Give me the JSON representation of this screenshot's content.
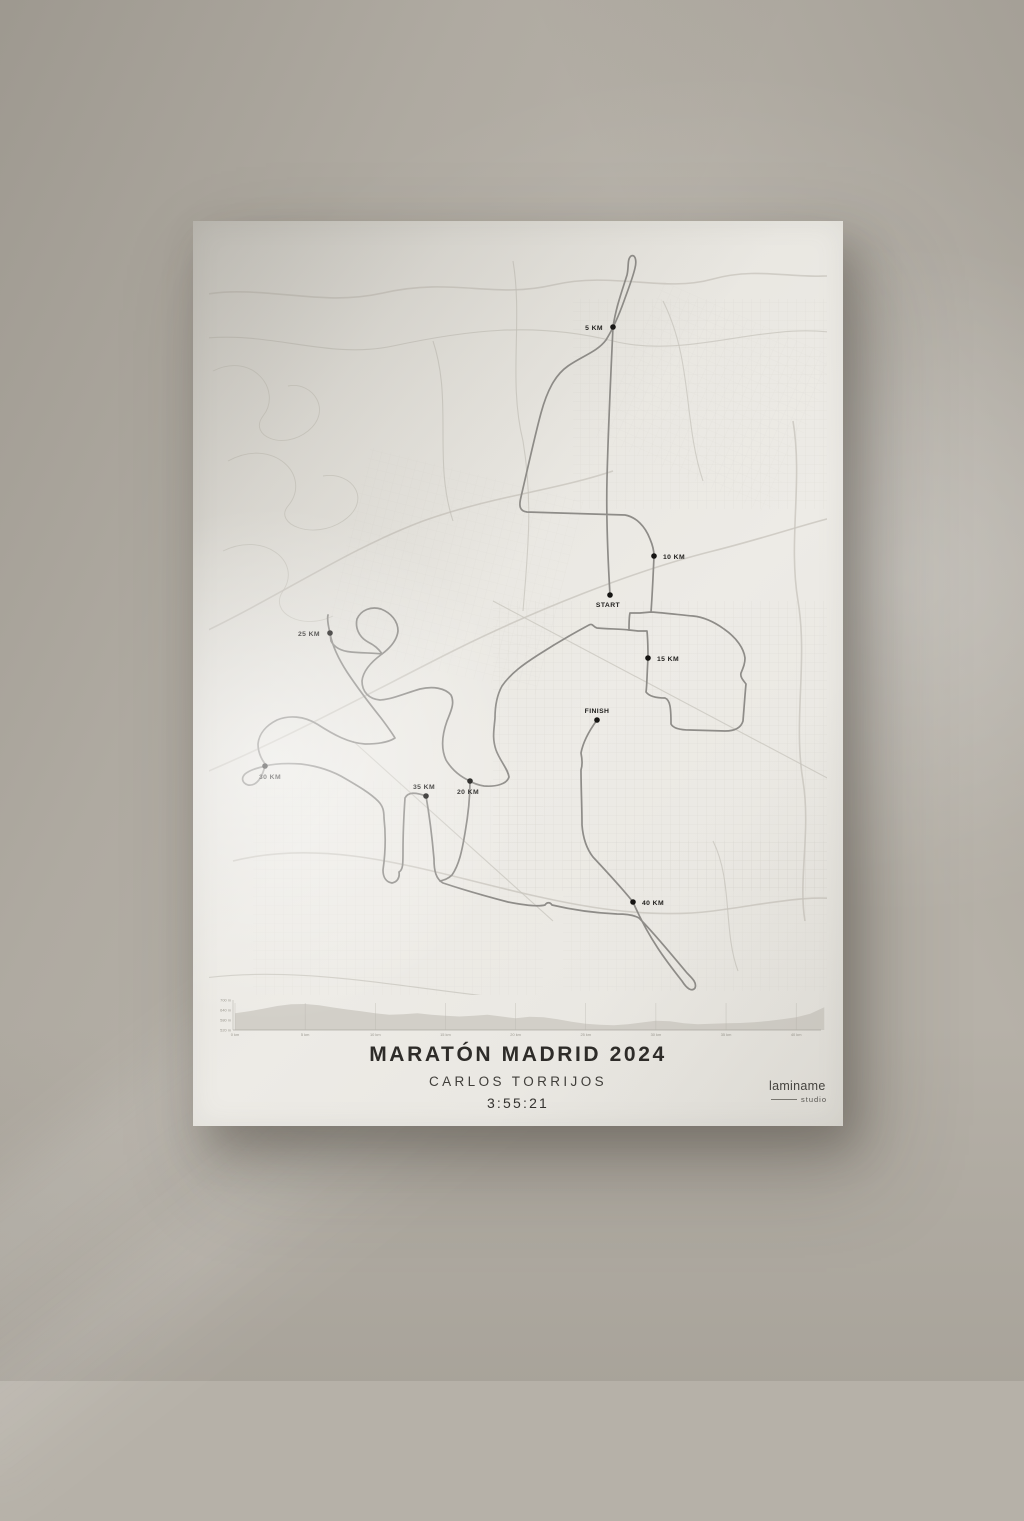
{
  "poster": {
    "title": "MARATÓN MADRID 2024",
    "runner": "CARLOS TORRIJOS",
    "time": "3:55:21",
    "brand": {
      "name": "laminame",
      "sub": "studio"
    }
  },
  "map": {
    "markers": [
      {
        "label": "START",
        "x": 417,
        "y": 374,
        "lx": 415,
        "ly": 386,
        "anchor": "middle"
      },
      {
        "label": "5 KM",
        "x": 420,
        "y": 106,
        "lx": 410,
        "ly": 109,
        "anchor": "end"
      },
      {
        "label": "10 KM",
        "x": 461,
        "y": 335,
        "lx": 470,
        "ly": 338,
        "anchor": "start"
      },
      {
        "label": "15 KM",
        "x": 455,
        "y": 437,
        "lx": 464,
        "ly": 440,
        "anchor": "start"
      },
      {
        "label": "20 KM",
        "x": 277,
        "y": 560,
        "lx": 275,
        "ly": 573,
        "anchor": "middle"
      },
      {
        "label": "25 KM",
        "x": 137,
        "y": 412,
        "lx": 127,
        "ly": 415,
        "anchor": "end"
      },
      {
        "label": "30 KM",
        "x": 72,
        "y": 545,
        "lx": 77,
        "ly": 558,
        "anchor": "middle"
      },
      {
        "label": "35 KM",
        "x": 233,
        "y": 575,
        "lx": 231,
        "ly": 568,
        "anchor": "middle"
      },
      {
        "label": "40 KM",
        "x": 440,
        "y": 681,
        "lx": 449,
        "ly": 684,
        "anchor": "start"
      },
      {
        "label": "FINISH",
        "x": 404,
        "y": 499,
        "lx": 404,
        "ly": 492,
        "anchor": "middle"
      }
    ]
  },
  "chart_data": {
    "type": "area",
    "title": "Elevation profile",
    "xlabel": "distance",
    "ylabel": "elevation",
    "x_tick_labels": [
      "0 km",
      "5 km",
      "10 km",
      "15 km",
      "20 km",
      "25 km",
      "30 km",
      "35 km",
      "40 km"
    ],
    "y_tick_labels": [
      "700 m",
      "640 m",
      "580 m",
      "520 m"
    ],
    "y_tick_values": [
      700,
      640,
      580,
      520
    ],
    "ylim": [
      520,
      700
    ],
    "xlim": [
      0,
      42
    ],
    "km": [
      0,
      1,
      2,
      3,
      4,
      5,
      6,
      7,
      8,
      9,
      10,
      11,
      12,
      13,
      14,
      15,
      16,
      17,
      18,
      19,
      20,
      21,
      22,
      23,
      24,
      25,
      26,
      27,
      28,
      29,
      30,
      31,
      32,
      33,
      34,
      35,
      36,
      37,
      38,
      39,
      40,
      41,
      42
    ],
    "elevation_m": [
      620,
      632,
      648,
      664,
      674,
      676,
      668,
      655,
      643,
      632,
      620,
      612,
      615,
      620,
      612,
      606,
      601,
      606,
      611,
      601,
      590,
      600,
      597,
      584,
      570,
      557,
      551,
      549,
      554,
      565,
      576,
      572,
      560,
      555,
      558,
      560,
      562,
      567,
      574,
      584,
      596,
      618,
      656
    ]
  }
}
